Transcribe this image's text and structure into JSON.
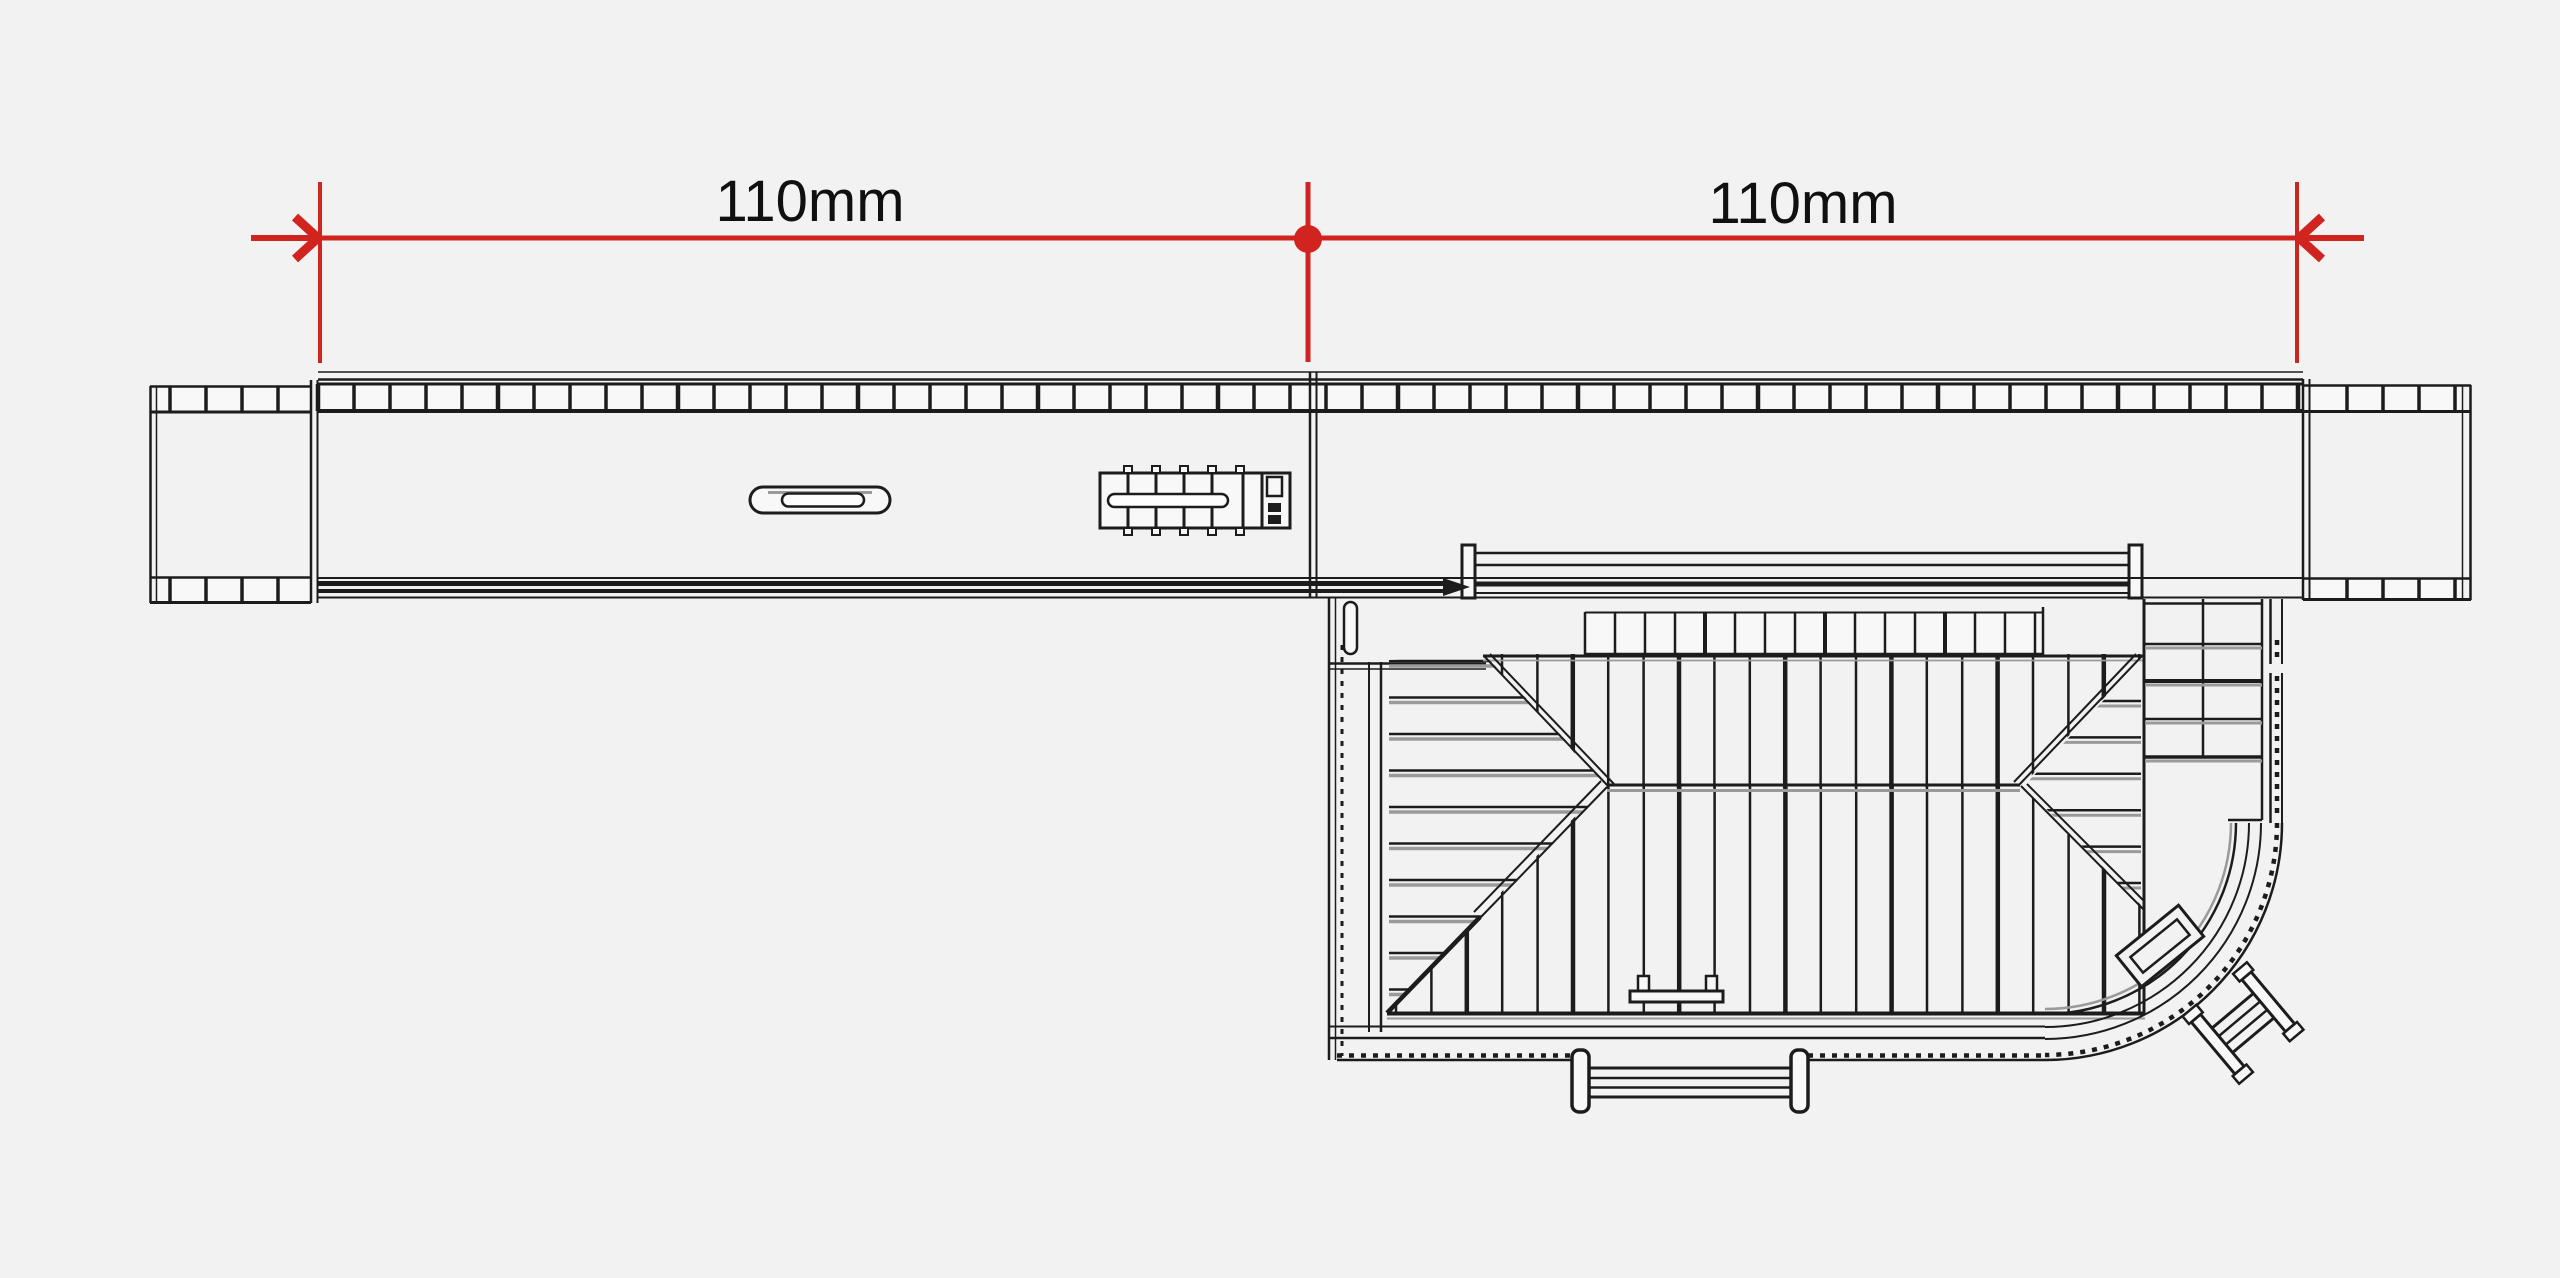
{
  "title": "Platform dimension drawing",
  "dimension": {
    "left_label": "110mm",
    "right_label": "110mm",
    "left_value": 110,
    "right_value": 110,
    "unit": "mm",
    "color": "#d1241f"
  },
  "drawing": {
    "background": "#f2f2f2",
    "ink": "#1c1c1c",
    "shadow": "#9a9a9a",
    "fill": "#f8f8f8",
    "parts": {
      "platform": "passenger platform with tiled edge",
      "left_ramp": "platform end ramp (left)",
      "right_ramp": "platform end ramp (right)",
      "bench": "platform bench",
      "shelter": "platform seat / shelter",
      "building": "station building roof plan",
      "canopy": "platform canopy",
      "fence": "veranda fence",
      "corner_steps": "corner entrance steps"
    }
  }
}
